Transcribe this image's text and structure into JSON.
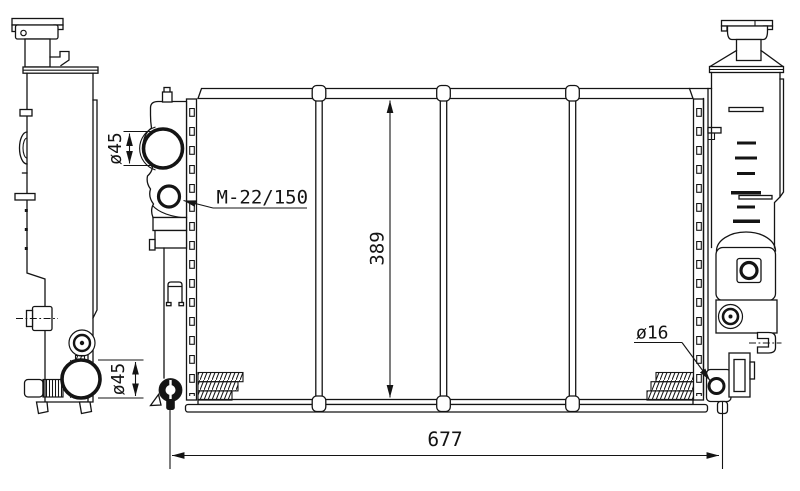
{
  "page": {
    "background": "#ffffff",
    "line_color": "#141414"
  },
  "dimensions": {
    "inlet_diameter_label": "ø45",
    "filler_thread_label": "M-22/150",
    "core_height_label": "389",
    "outlet_diameter_label": "ø45",
    "drain_diameter_label": "ø16",
    "overall_width_label": "677"
  }
}
